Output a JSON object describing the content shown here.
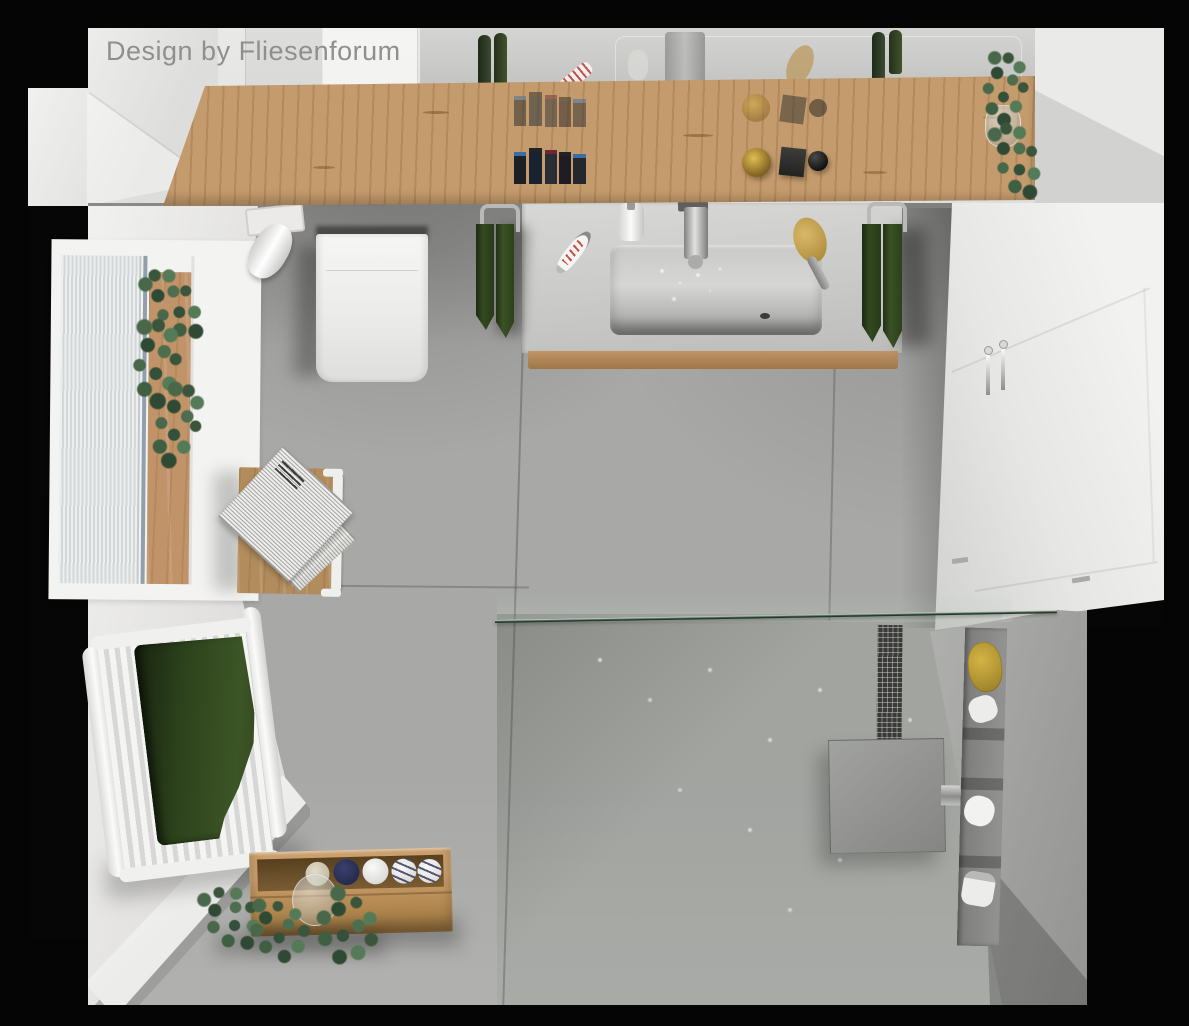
{
  "watermark": {
    "text": "Design by Fliesenforum"
  },
  "scene": {
    "description": "Top-down 3D rendering of a modern bathroom",
    "style": "photorealistic architectural render",
    "frame_color": "#000000"
  },
  "palette": {
    "wall": "#e8e8e6",
    "floor_tile": "#a8a8a6",
    "floor_tile_light": "#b2b2b0",
    "wood_oak": "#c49b6c",
    "wood_crate": "#b1874f",
    "towel_green": "#2e4423",
    "candle_green": "#2d3a26",
    "eucalyptus_green": "#49684a",
    "glass_edge_green": "#2c4534",
    "shower_floor": "#9aa39c",
    "chrome": "#b5b5b3",
    "sponge_yellow": "#c9a83f",
    "navy_roll": "#2a2f58",
    "toothpaste_red": "#c03028",
    "ceramic_white": "#f2f2f0"
  },
  "objects": [
    {
      "id": "mirror",
      "label": "wall mirror with reflections"
    },
    {
      "id": "wooden-shelf",
      "label": "oak shelf with cosmetics and candles"
    },
    {
      "id": "vanity",
      "label": "washbasin vanity with running faucet"
    },
    {
      "id": "toilet",
      "label": "toilet with paper holder and flush plate"
    },
    {
      "id": "window",
      "label": "window with blinds and plant board"
    },
    {
      "id": "side-table",
      "label": "stool with newspaper"
    },
    {
      "id": "radiator",
      "label": "white radiator with green towel"
    },
    {
      "id": "storage-crate",
      "label": "wooden crate with rolled towels"
    },
    {
      "id": "eucalyptus",
      "label": "eucalyptus sprigs in glass vases"
    },
    {
      "id": "walk-in-shower",
      "label": "walk-in shower with glass screen, rain head, mosaic strip and niche"
    },
    {
      "id": "tall-cabinet",
      "label": "tall white cabinet with chrome handles"
    }
  ]
}
